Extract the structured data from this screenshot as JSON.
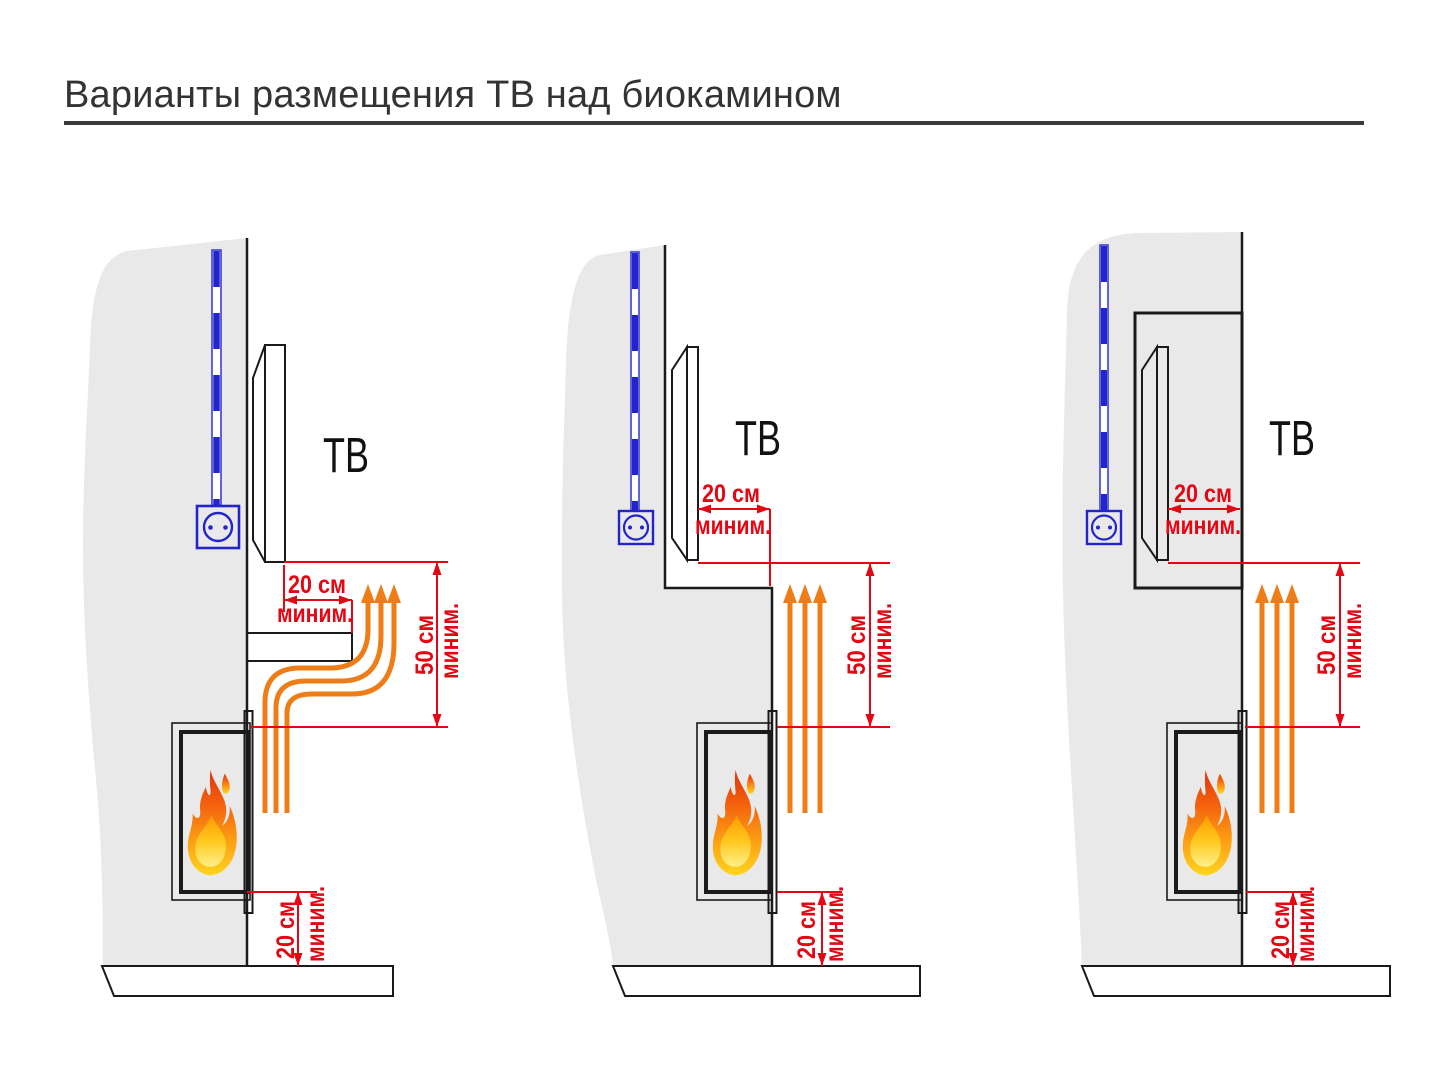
{
  "title": "Варианты размещения ТВ над биокамином",
  "colors": {
    "dimension_red": "#e30613",
    "heat_arrow_orange": "#ee7d17",
    "cable_blue": "#2424cd",
    "wall_gray": "#e9e9e9",
    "slab_gray": "#c9c9c9",
    "tv_gray": "#9a9a9a",
    "outline_black": "#1a1a1a"
  },
  "diagrams": [
    {
      "id": "tv-above-protective-shelf",
      "tv_label": "ТВ",
      "tv_clearance": {
        "value": "20 см",
        "qualifier": "миним."
      },
      "heat_clearance": {
        "value": "50 см",
        "qualifier": "миним."
      },
      "floor_clearance": {
        "value": "20 см",
        "qualifier": "миним."
      }
    },
    {
      "id": "tv-on-recessed-wall-step",
      "tv_label": "ТВ",
      "tv_clearance": {
        "value": "20 см",
        "qualifier": "миним."
      },
      "heat_clearance": {
        "value": "50 см",
        "qualifier": "миним."
      },
      "floor_clearance": {
        "value": "20 см",
        "qualifier": "миним."
      }
    },
    {
      "id": "tv-inside-wall-niche",
      "tv_label": "ТВ",
      "tv_clearance": {
        "value": "20 см",
        "qualifier": "миним."
      },
      "heat_clearance": {
        "value": "50 см",
        "qualifier": "миним."
      },
      "floor_clearance": {
        "value": "20 см",
        "qualifier": "миним."
      }
    }
  ]
}
